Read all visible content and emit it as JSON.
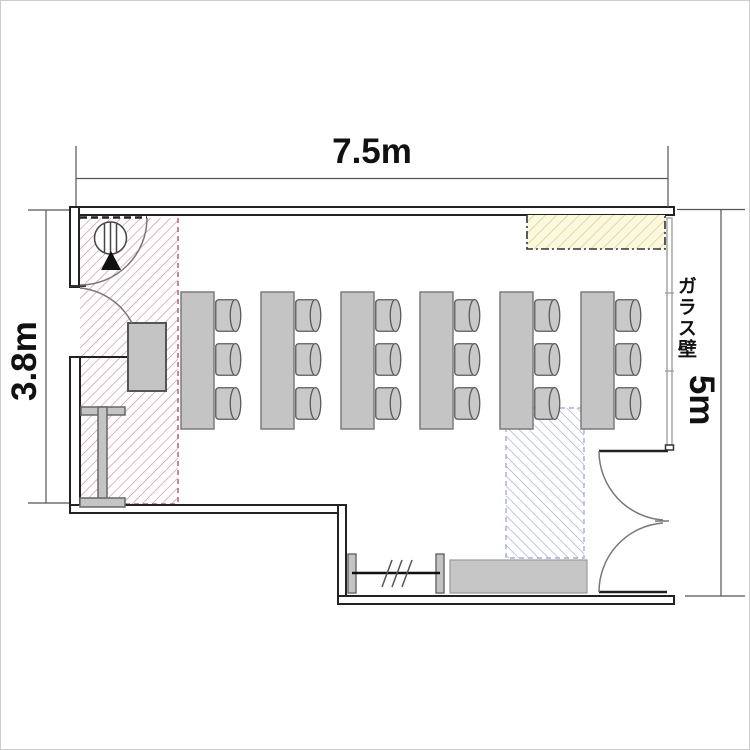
{
  "plan": {
    "dimensions": {
      "top_width": "7.5m",
      "left_height": "3.8m",
      "right_height": "5m"
    },
    "labels": {
      "glass_wall": "ガラス壁"
    },
    "furniture_counts": {
      "tables": 6,
      "chairs_per_table": 3,
      "chairs_total": 18,
      "benches": 1,
      "reception_desks": 1,
      "shelf_units": 1
    },
    "icons": {
      "entrance_arrow": "black upward triangle",
      "pillar_symbol": "circle with three vertical bars",
      "door_swing": "quarter-circle arc",
      "double_door": "two facing quarter-circle arcs",
      "coat_rail": "horizontal line with three slashes"
    },
    "colors": {
      "background": "#ffffff",
      "wall_line": "#222222",
      "furniture_fill": "#c4c4c4",
      "furniture_border": "#666666",
      "entrance_hatch": "#c9839b",
      "aisle_hatch": "#98a0cc",
      "counter_zone_fill": "#fbf8e0",
      "counter_zone_line": "#d9cf7e",
      "dimension_line": "#555555"
    }
  }
}
